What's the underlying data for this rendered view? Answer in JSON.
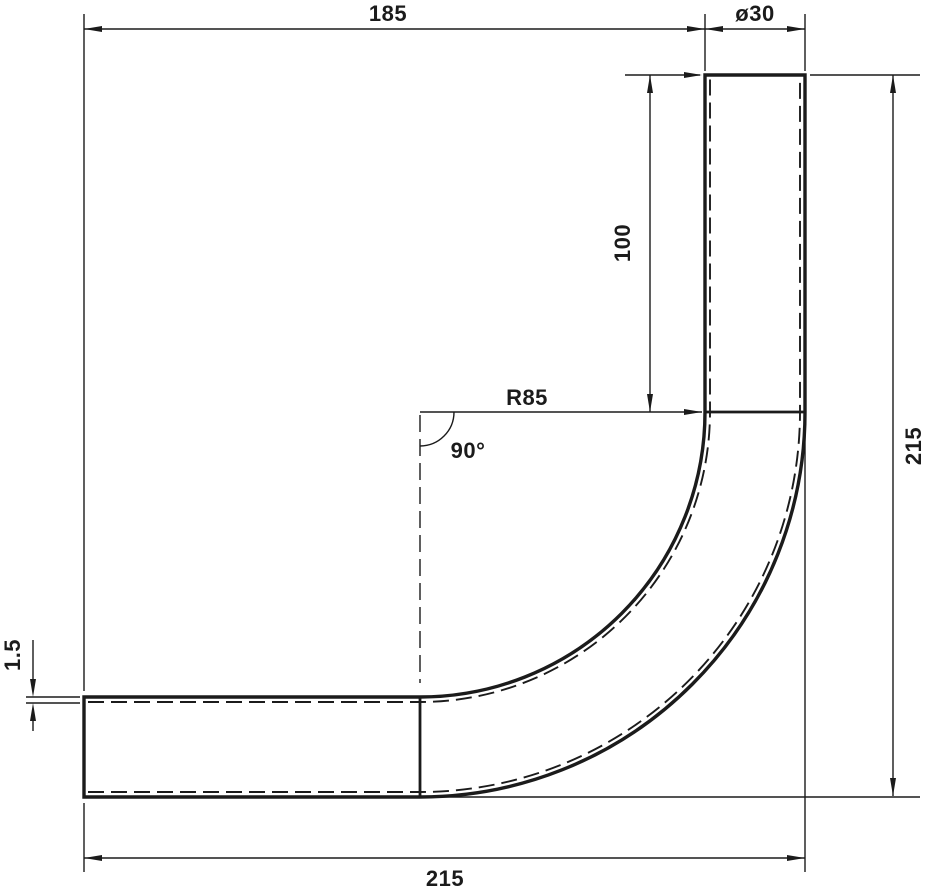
{
  "drawing": {
    "background": "#ffffff",
    "line_color": "#1b1b1b",
    "dimensions": {
      "top_width": "185",
      "diameter": "ø30",
      "leg_length": "100",
      "bend_radius": "R85",
      "bend_angle": "90°",
      "overall_height": "215",
      "overall_width": "215",
      "wall_thickness": "1.5"
    }
  }
}
